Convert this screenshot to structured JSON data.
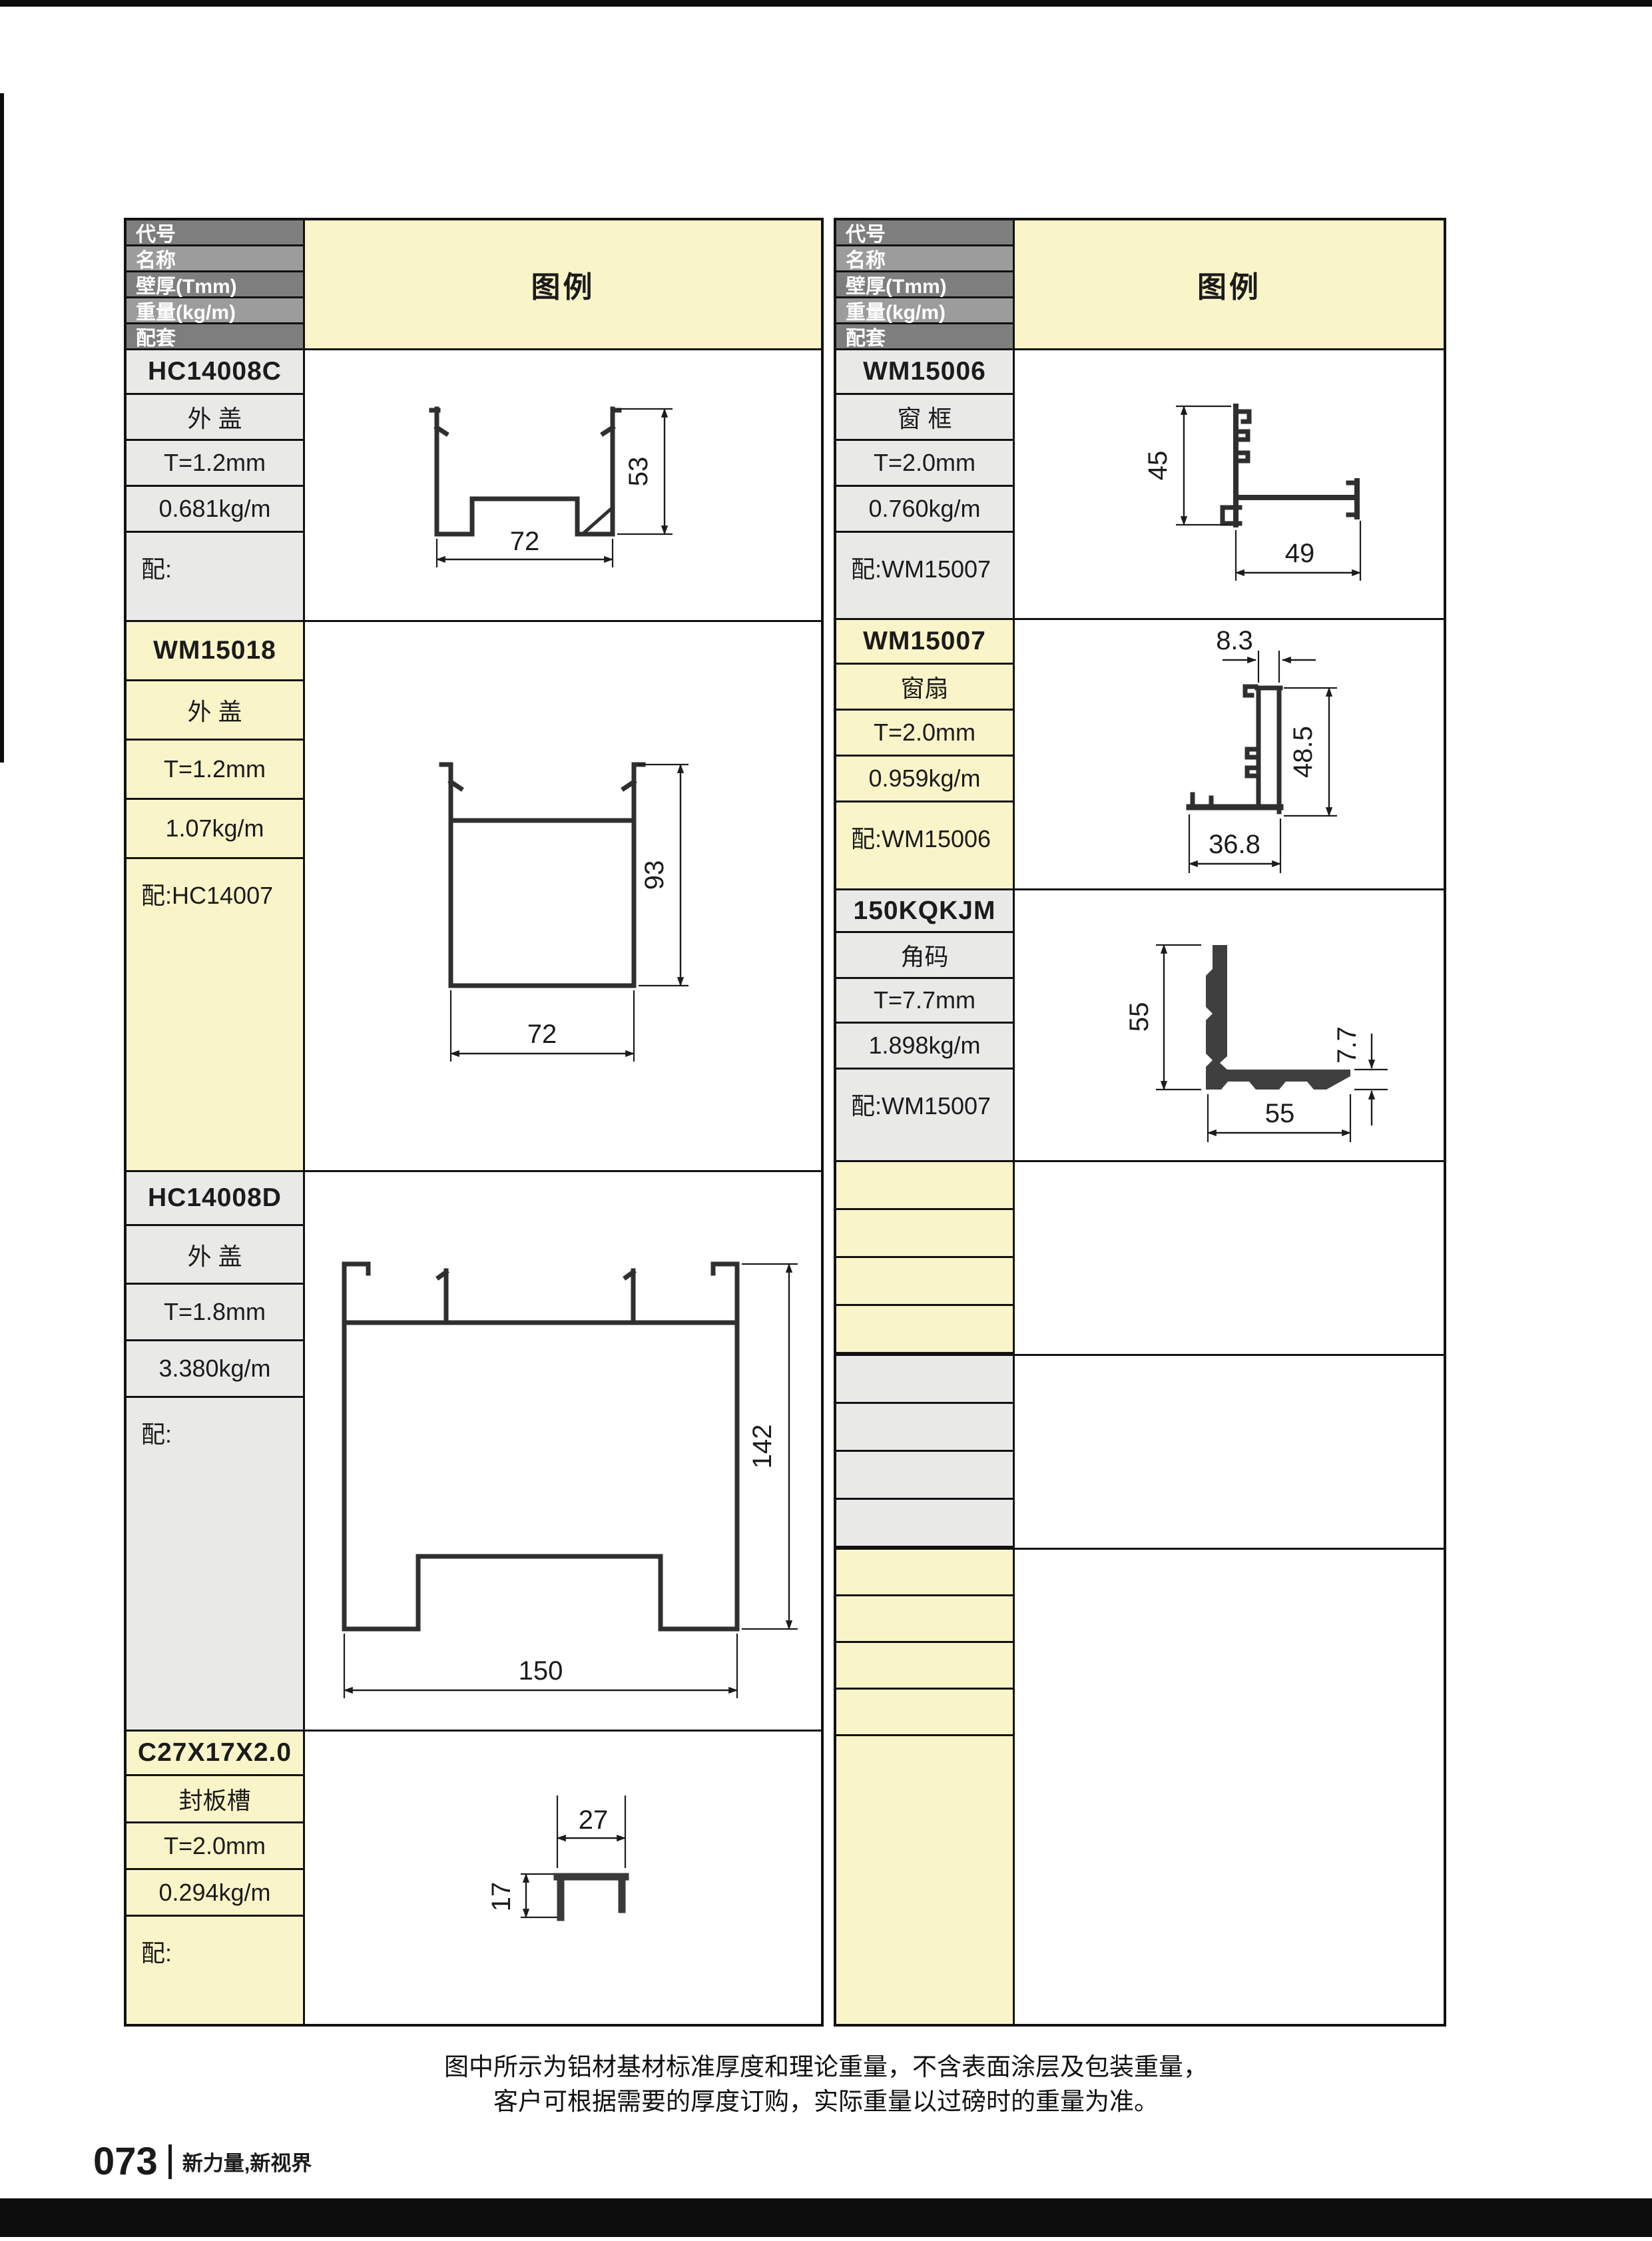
{
  "table_header": {
    "row1": "代号",
    "row2": "名称",
    "row3": "壁厚(Tmm)",
    "row4": "重量(kg/m)",
    "row5": "配套",
    "legend": "图例"
  },
  "left_table": {
    "blocks": [
      {
        "code": "HC14008C",
        "name": "外 盖",
        "thickness": "T=1.2mm",
        "weight": "0.681kg/m",
        "match": "配:",
        "dims": {
          "width": "72",
          "height": "53"
        }
      },
      {
        "code": "WM15018",
        "name": "外 盖",
        "thickness": "T=1.2mm",
        "weight": "1.07kg/m",
        "match": "配:HC14007",
        "dims": {
          "width": "72",
          "height": "93"
        }
      },
      {
        "code": "HC14008D",
        "name": "外 盖",
        "thickness": "T=1.8mm",
        "weight": "3.380kg/m",
        "match": "配:",
        "dims": {
          "width": "150",
          "height": "142"
        }
      },
      {
        "code": "C27X17X2.0",
        "name": "封板槽",
        "thickness": "T=2.0mm",
        "weight": "0.294kg/m",
        "match": "配:",
        "dims": {
          "width": "27",
          "height": "17"
        }
      }
    ]
  },
  "right_table": {
    "blocks": [
      {
        "code": "WM15006",
        "name": "窗 框",
        "thickness": "T=2.0mm",
        "weight": "0.760kg/m",
        "match": "配:WM15007",
        "dims": {
          "height": "45",
          "width": "49"
        }
      },
      {
        "code": "WM15007",
        "name": "窗扇",
        "thickness": "T=2.0mm",
        "weight": "0.959kg/m",
        "match": "配:WM15006",
        "dims": {
          "top_width": "8.3",
          "height": "48.5",
          "width": "36.8"
        }
      },
      {
        "code": "150KQKJM",
        "name": "角码",
        "thickness": "T=7.7mm",
        "weight": "1.898kg/m",
        "match": "配:WM15007",
        "dims": {
          "height": "55",
          "width": "55",
          "thickness": "7.7"
        }
      }
    ]
  },
  "footer": {
    "note_line1": "图中所示为铝材基材标准厚度和理论重量，不含表面涂层及包装重量，",
    "note_line2": "客户可根据需要的厚度订购，实际重量以过磅时的重量为准。",
    "page_number": "073",
    "tagline": "新力量,新视界"
  },
  "colors": {
    "yellow": "#FAF5C8",
    "gray": "#E9E9E8",
    "header_dark": "#7E7E7E",
    "header_light": "#9C9C9C",
    "border": "#111111",
    "drawing_line": "#2F2F2F"
  }
}
